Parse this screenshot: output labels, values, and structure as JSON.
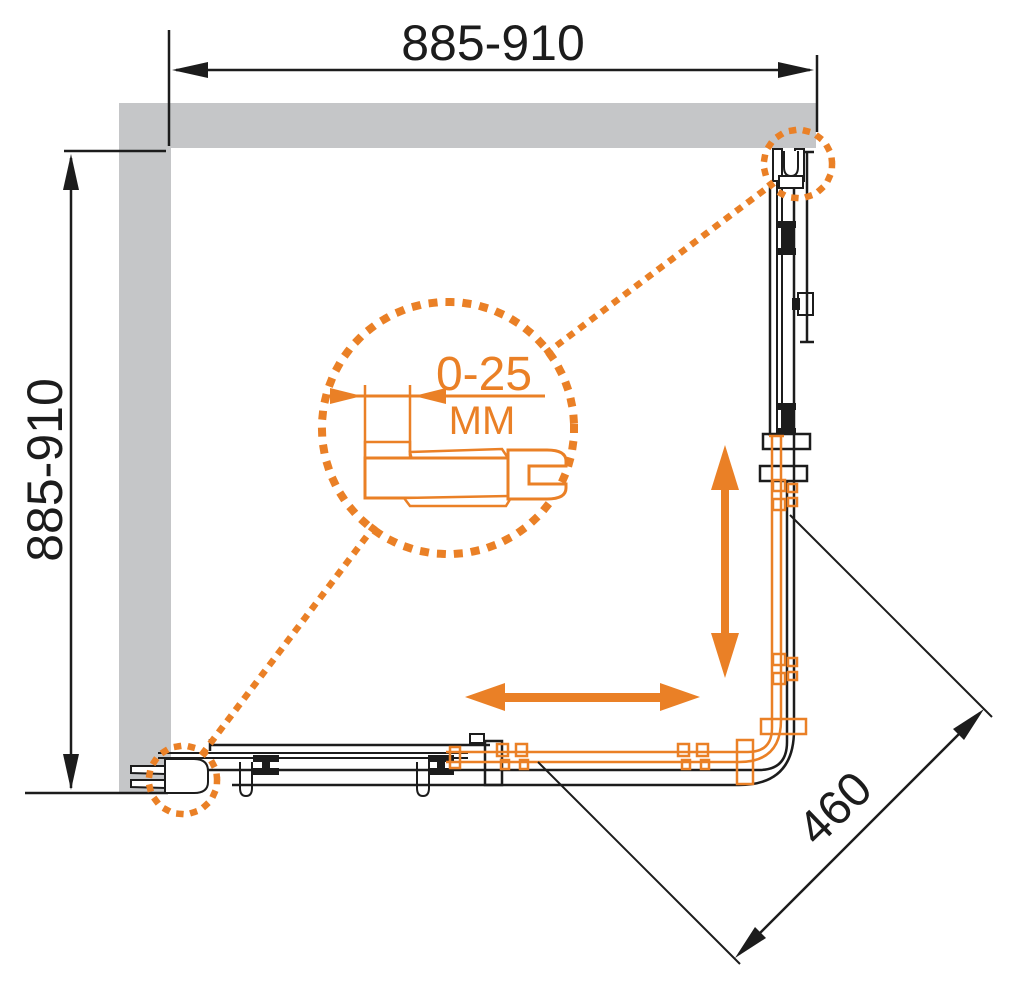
{
  "diagram": {
    "type": "technical-drawing",
    "subject": "corner shower enclosure, top view, sliding doors with wall mounting profiles",
    "dimensions": {
      "top_width": "885-910",
      "left_depth": "885-910",
      "diagonal_entry": "460",
      "wall_profile_adjustment": "0-25",
      "unit_label": "MM"
    },
    "colors": {
      "accent_orange": "#ea8026",
      "wall_gray": "#c5c6c8",
      "line_black": "#1c1c1c",
      "background": "#ffffff"
    }
  }
}
